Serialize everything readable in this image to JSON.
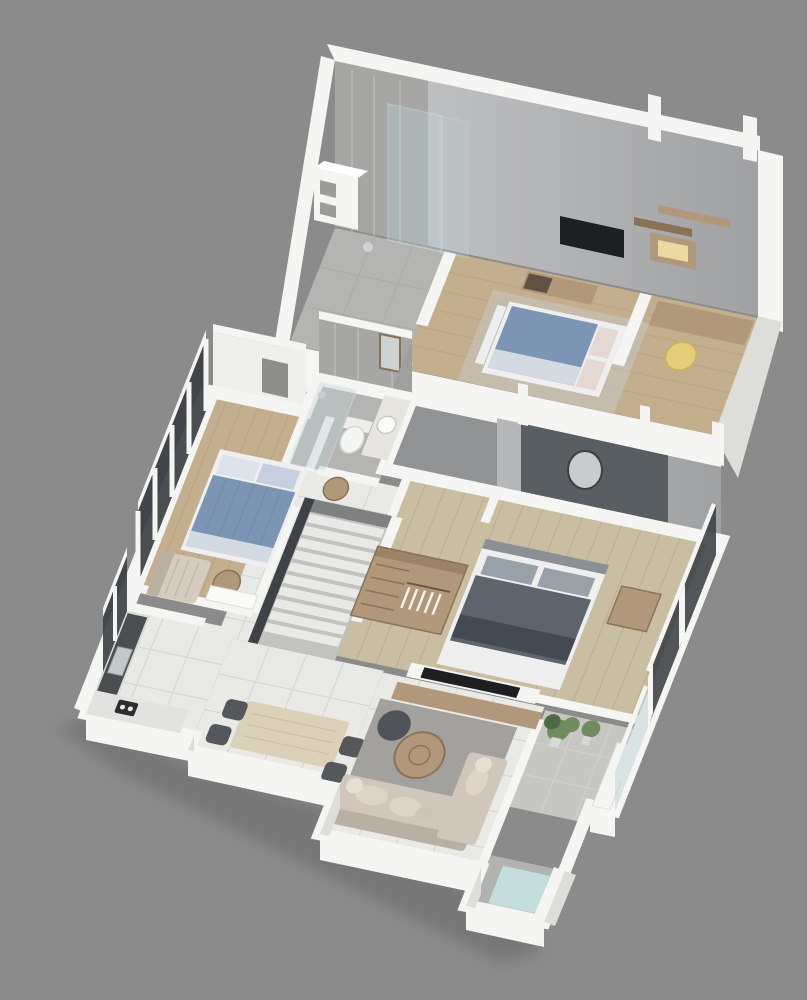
{
  "scene": {
    "type": "axonometric-floorplan-render",
    "floors": [
      {
        "id": "upper-floor",
        "rooms": [
          "bathroom",
          "bedroom",
          "workspace"
        ]
      },
      {
        "id": "lower-floor",
        "rooms": [
          "bedroom",
          "bathroom",
          "hallway",
          "staircase",
          "walk-in-closet",
          "master-bedroom",
          "kitchen",
          "dining-area",
          "living-room",
          "balcony",
          "utility-nook"
        ]
      }
    ]
  },
  "colors": {
    "background": "#8b8b8b",
    "wall-white": "#f5f5f3",
    "wall-shade": "#dddddA",
    "wall-side": "#c9c9c5",
    "wall-gray": "#909294",
    "back-wall-a": "#c7c8c9",
    "back-wall-b": "#a0a1a3",
    "back-wall-c": "#b6b8ba",
    "marble": "#a6a7a5",
    "marble-line": "#cfd0ce",
    "wood-floor": "#c3ae8e",
    "wood-floor-2": "#c9bda2",
    "wood-line": "#a6906f",
    "tile": "#e9e9e6",
    "tile-line": "#d2d2ce",
    "glass": "#bcd4d6",
    "window-dark": "#3b3f43",
    "accent-wall": "#595e63",
    "bed-blue": "#7c95b4",
    "bed-blue-light": "#d3dae2",
    "bed-white": "#efeff0",
    "pillow-warm": "#e3d9d2",
    "master-bed": "#5d646c",
    "master-bed-dark": "#434a52",
    "master-pillow": "#98a0a8",
    "wood-furniture": "#b2987a",
    "wood-dark": "#8a7257",
    "tv-black": "#1d1f21",
    "chair-yellow": "#e5cd7a",
    "sofa": "#cfc8ba",
    "sofa-dark": "#b8b1a3",
    "rug": "#a2a19d",
    "rug-light": "#c9c8c4",
    "plant": "#6f8c5f",
    "plant-dark": "#4e6b42",
    "stair-light": "#e9e9e7",
    "stair-base": "#c2c2bf",
    "rail-dark": "#3f4347",
    "chair-dark": "#54585c",
    "counter-dark": "#4b4e50",
    "steel": "#c3c8cb",
    "mat-blue": "#c4dedd",
    "shadow": "#3c3c3c",
    "glow": "#ecd9a0",
    "stone": "#b4b5b2"
  }
}
